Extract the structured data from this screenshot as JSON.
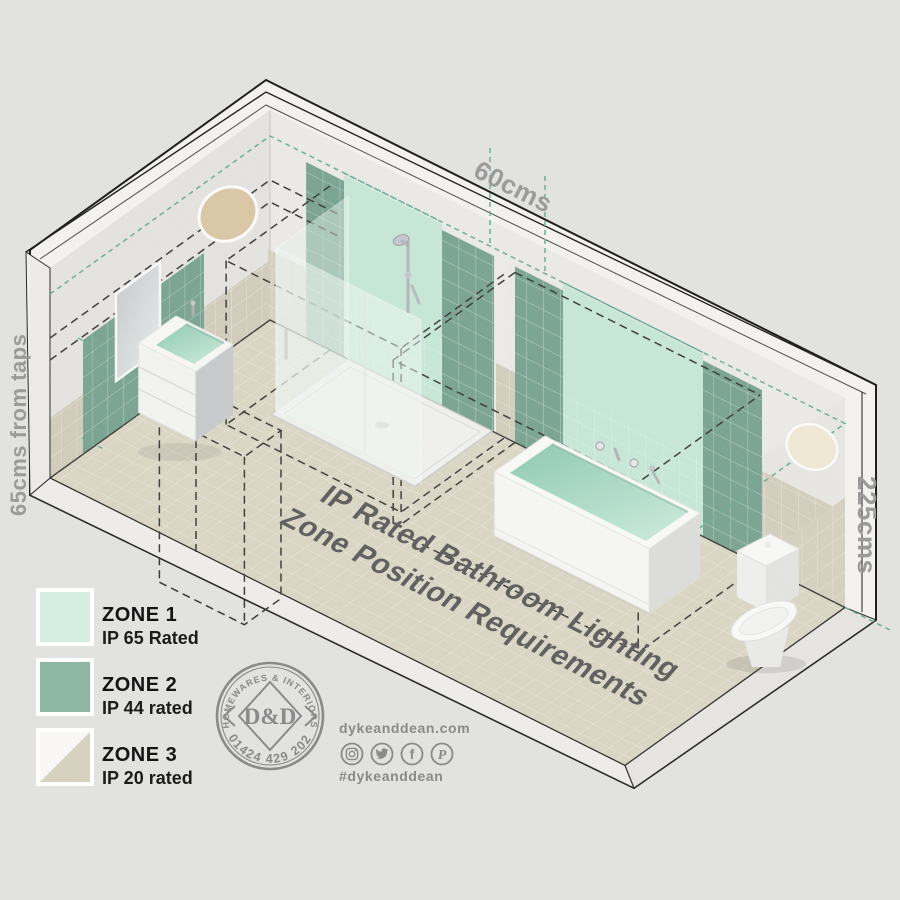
{
  "diagram": {
    "title_line1": "IP Rated Bathroom Lighting",
    "title_line2": "Zone Position Requirements",
    "dim_top": "60cms",
    "dim_left": "65cms from taps",
    "dim_right": "225cms"
  },
  "legend": {
    "items": [
      {
        "zone": "ZONE 1",
        "rating": "IP 65 Rated",
        "color": "#d6eee2"
      },
      {
        "zone": "ZONE 2",
        "rating": "IP 44 rated",
        "color": "#8db7a3"
      },
      {
        "zone": "ZONE 3",
        "rating": "IP 20 rated",
        "color_light": "#f8f7f5",
        "color_dark": "#d7d1bf"
      }
    ]
  },
  "brand": {
    "stamp_top": "HOMEWARES & INTERIORS",
    "monogram": "D&D",
    "phone": "01424 429 202",
    "website": "dykeanddean.com",
    "hashtag": "#dykeanddean",
    "facebook_glyph": "f",
    "pinterest_glyph": "P",
    "social_icons": [
      "instagram",
      "twitter",
      "facebook",
      "pinterest"
    ]
  },
  "palette": {
    "zone1_panel": "#c9ead9",
    "zone2_panel": "#7aa593",
    "floor_tile": "#ddd8c6",
    "beige_tile": "#d6d0bf",
    "dash_teal": "#6fae9c",
    "dash_black": "#3b3b3b"
  }
}
